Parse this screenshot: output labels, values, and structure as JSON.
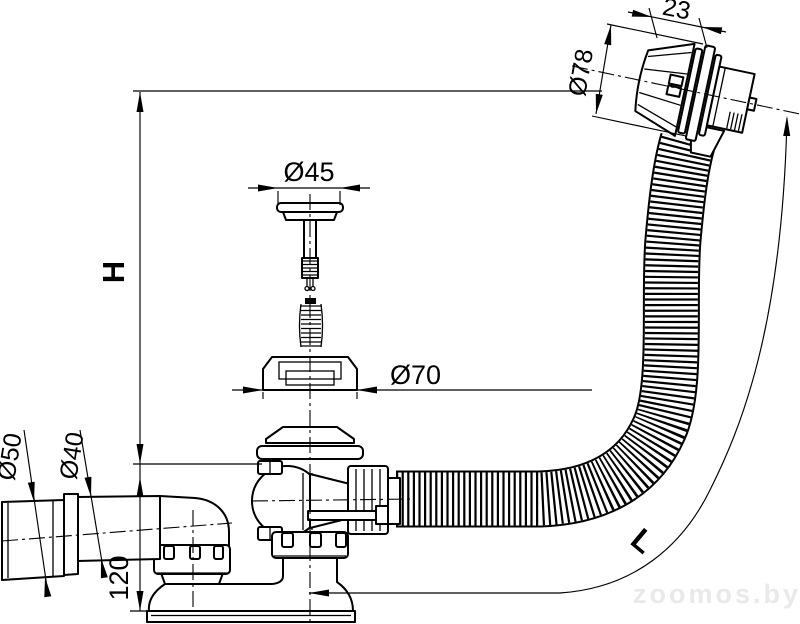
{
  "drawing": {
    "type": "technical-dimension-drawing",
    "subject": "bath waste and overflow drain set with corrugated hose",
    "background_color": "#ffffff",
    "line_color": "#000000",
    "labels": {
      "height": "H",
      "hose_length": "L",
      "overflow_depth": "23",
      "overflow_diameter": "Ø78",
      "plug_diameter": "Ø45",
      "flange_diameter": "Ø70",
      "outlet_sleeve_diameter": "Ø50",
      "outlet_pipe_diameter": "Ø40",
      "drain_body_height": "120"
    },
    "watermark": {
      "text": "zoomos.by",
      "color": "#e9e9e9"
    }
  }
}
